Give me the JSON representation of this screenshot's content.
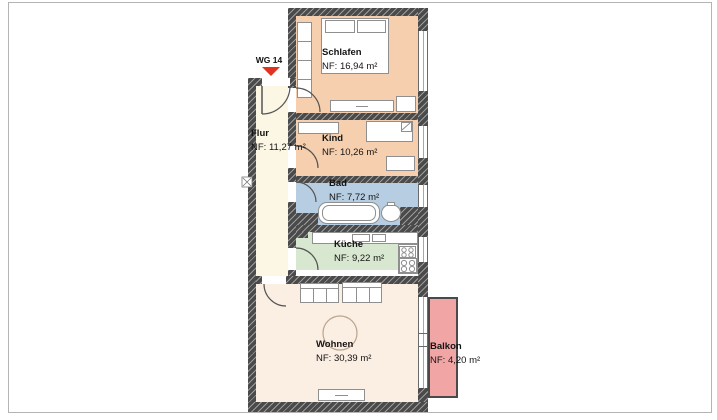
{
  "plan": {
    "entrance_label": "WG 14",
    "rooms": [
      {
        "name": "Schlafen",
        "area": "NF: 16,94 m²"
      },
      {
        "name": "Kind",
        "area": "NF: 10,26 m²"
      },
      {
        "name": "Bad",
        "area": "NF: 7,72 m²"
      },
      {
        "name": "Küche",
        "area": "NF: 9,22 m²"
      },
      {
        "name": "Flur",
        "area": "NF: 11,27 m²"
      },
      {
        "name": "Wohnen",
        "area": "NF: 30,39 m²"
      },
      {
        "name": "Balkon",
        "area": "NF: 4,20 m²"
      }
    ],
    "colors": {
      "bedroom_floor": "#f6cfae",
      "bath_floor": "#b7cde2",
      "kitchen_zone": "#d8e8d0",
      "hall_floor": "#fbf7e4",
      "living_floor": "#fbeee3",
      "balcony": "#f2a5a5",
      "wall": "#4a4a4a",
      "entrance_marker": "#e23222"
    }
  }
}
